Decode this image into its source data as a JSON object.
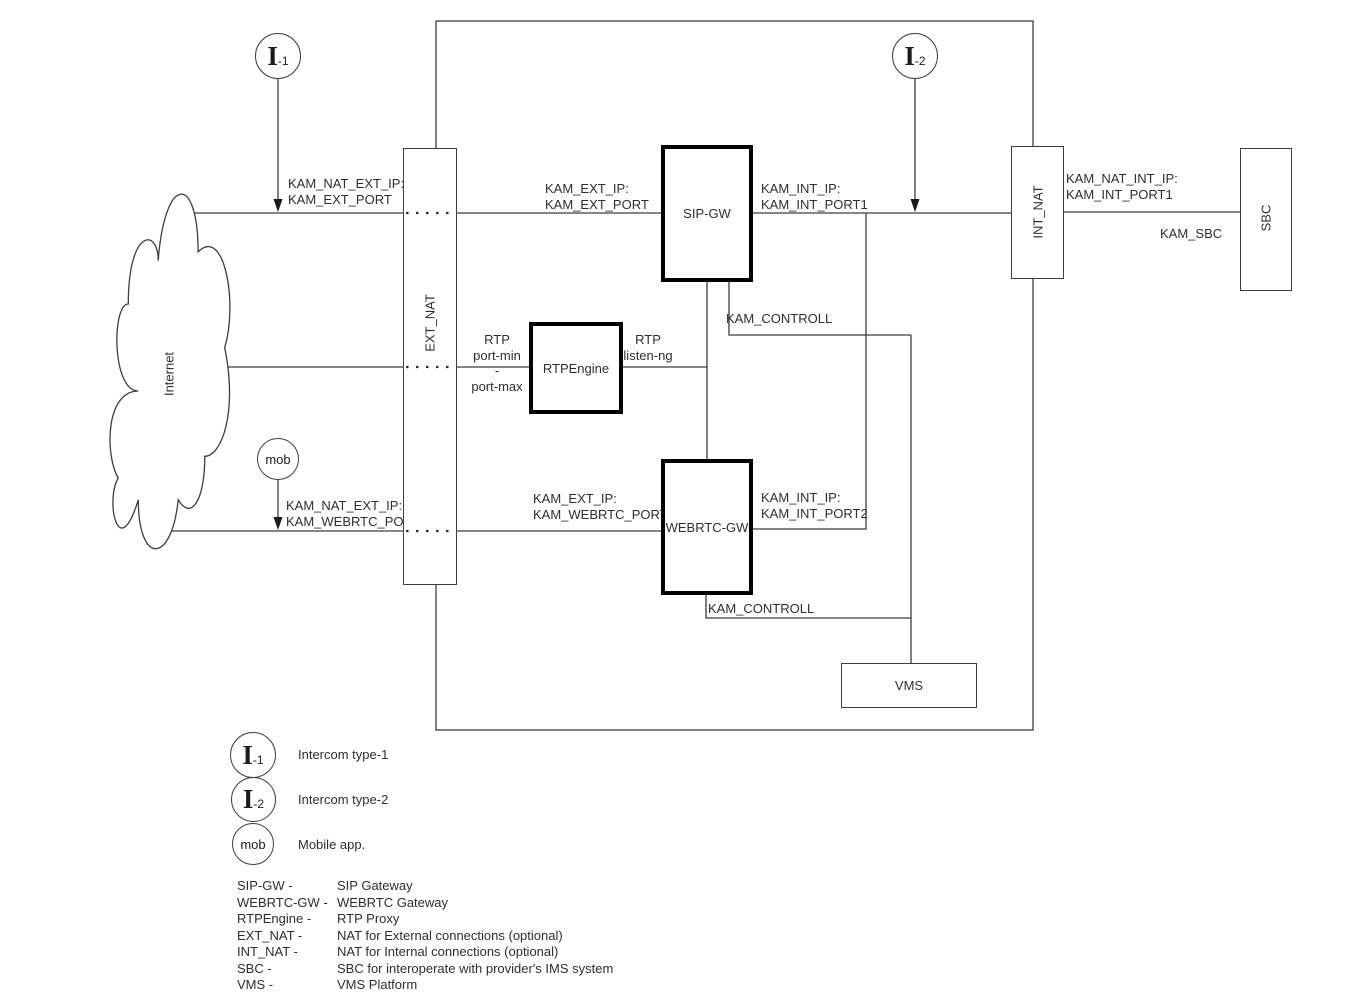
{
  "diagram": {
    "title_hint": "SIP / WebRTC gateway network diagram",
    "colors": {
      "line": "#3d3d3d",
      "thick_border": "#000000",
      "text": "#2e2e2e",
      "background": "#ffffff"
    },
    "nodes": {
      "internet": "Internet",
      "ext_nat": "EXT_NAT",
      "sip_gw": "SIP-GW",
      "rtpengine": "RTPEngine",
      "webrtc_gw": "WEBRTC-GW",
      "int_nat": "INT_NAT",
      "sbc": "SBC",
      "vms": "VMS"
    },
    "actors": {
      "i1": {
        "symbol": "I",
        "suffix": "-1"
      },
      "i2": {
        "symbol": "I",
        "suffix": "-2"
      },
      "mob": {
        "label": "mob"
      }
    },
    "labels": {
      "kam_nat_ext_ip": "KAM_NAT_EXT_IP:",
      "kam_ext_port": "KAM_EXT_PORT",
      "kam_ext_ip": "KAM_EXT_IP:",
      "kam_int_ip": "KAM_INT_IP:",
      "kam_int_port1": "KAM_INT_PORT1",
      "kam_int_port2": "KAM_INT_PORT2",
      "kam_webrtc_port": "KAM_WEBRTC_PORT",
      "kam_controll": "KAM_CONTROLL",
      "kam_nat_int_ip": "KAM_NAT_INT_IP:",
      "kam_sbc": "KAM_SBC",
      "rtp": "RTP",
      "port_min": "port-min",
      "dash": "-",
      "port_max": "port-max",
      "listen_ng": "listen-ng"
    },
    "legend_actors": [
      {
        "label": "Intercom type-1"
      },
      {
        "label": "Intercom type-2"
      },
      {
        "label": "Mobile app."
      }
    ],
    "legend_terms": [
      {
        "term": "SIP-GW -",
        "definition": "SIP Gateway"
      },
      {
        "term": "WEBRTC-GW -",
        "definition": "WEBRTC Gateway"
      },
      {
        "term": "RTPEngine -",
        "definition": "RTP Proxy"
      },
      {
        "term": "EXT_NAT -",
        "definition": "NAT for External connections (optional)"
      },
      {
        "term": "INT_NAT -",
        "definition": "NAT for Internal connections (optional)"
      },
      {
        "term": "SBC -",
        "definition": "SBC for interoperate with provider's IMS system"
      },
      {
        "term": "VMS -",
        "definition": "VMS Platform"
      }
    ]
  }
}
